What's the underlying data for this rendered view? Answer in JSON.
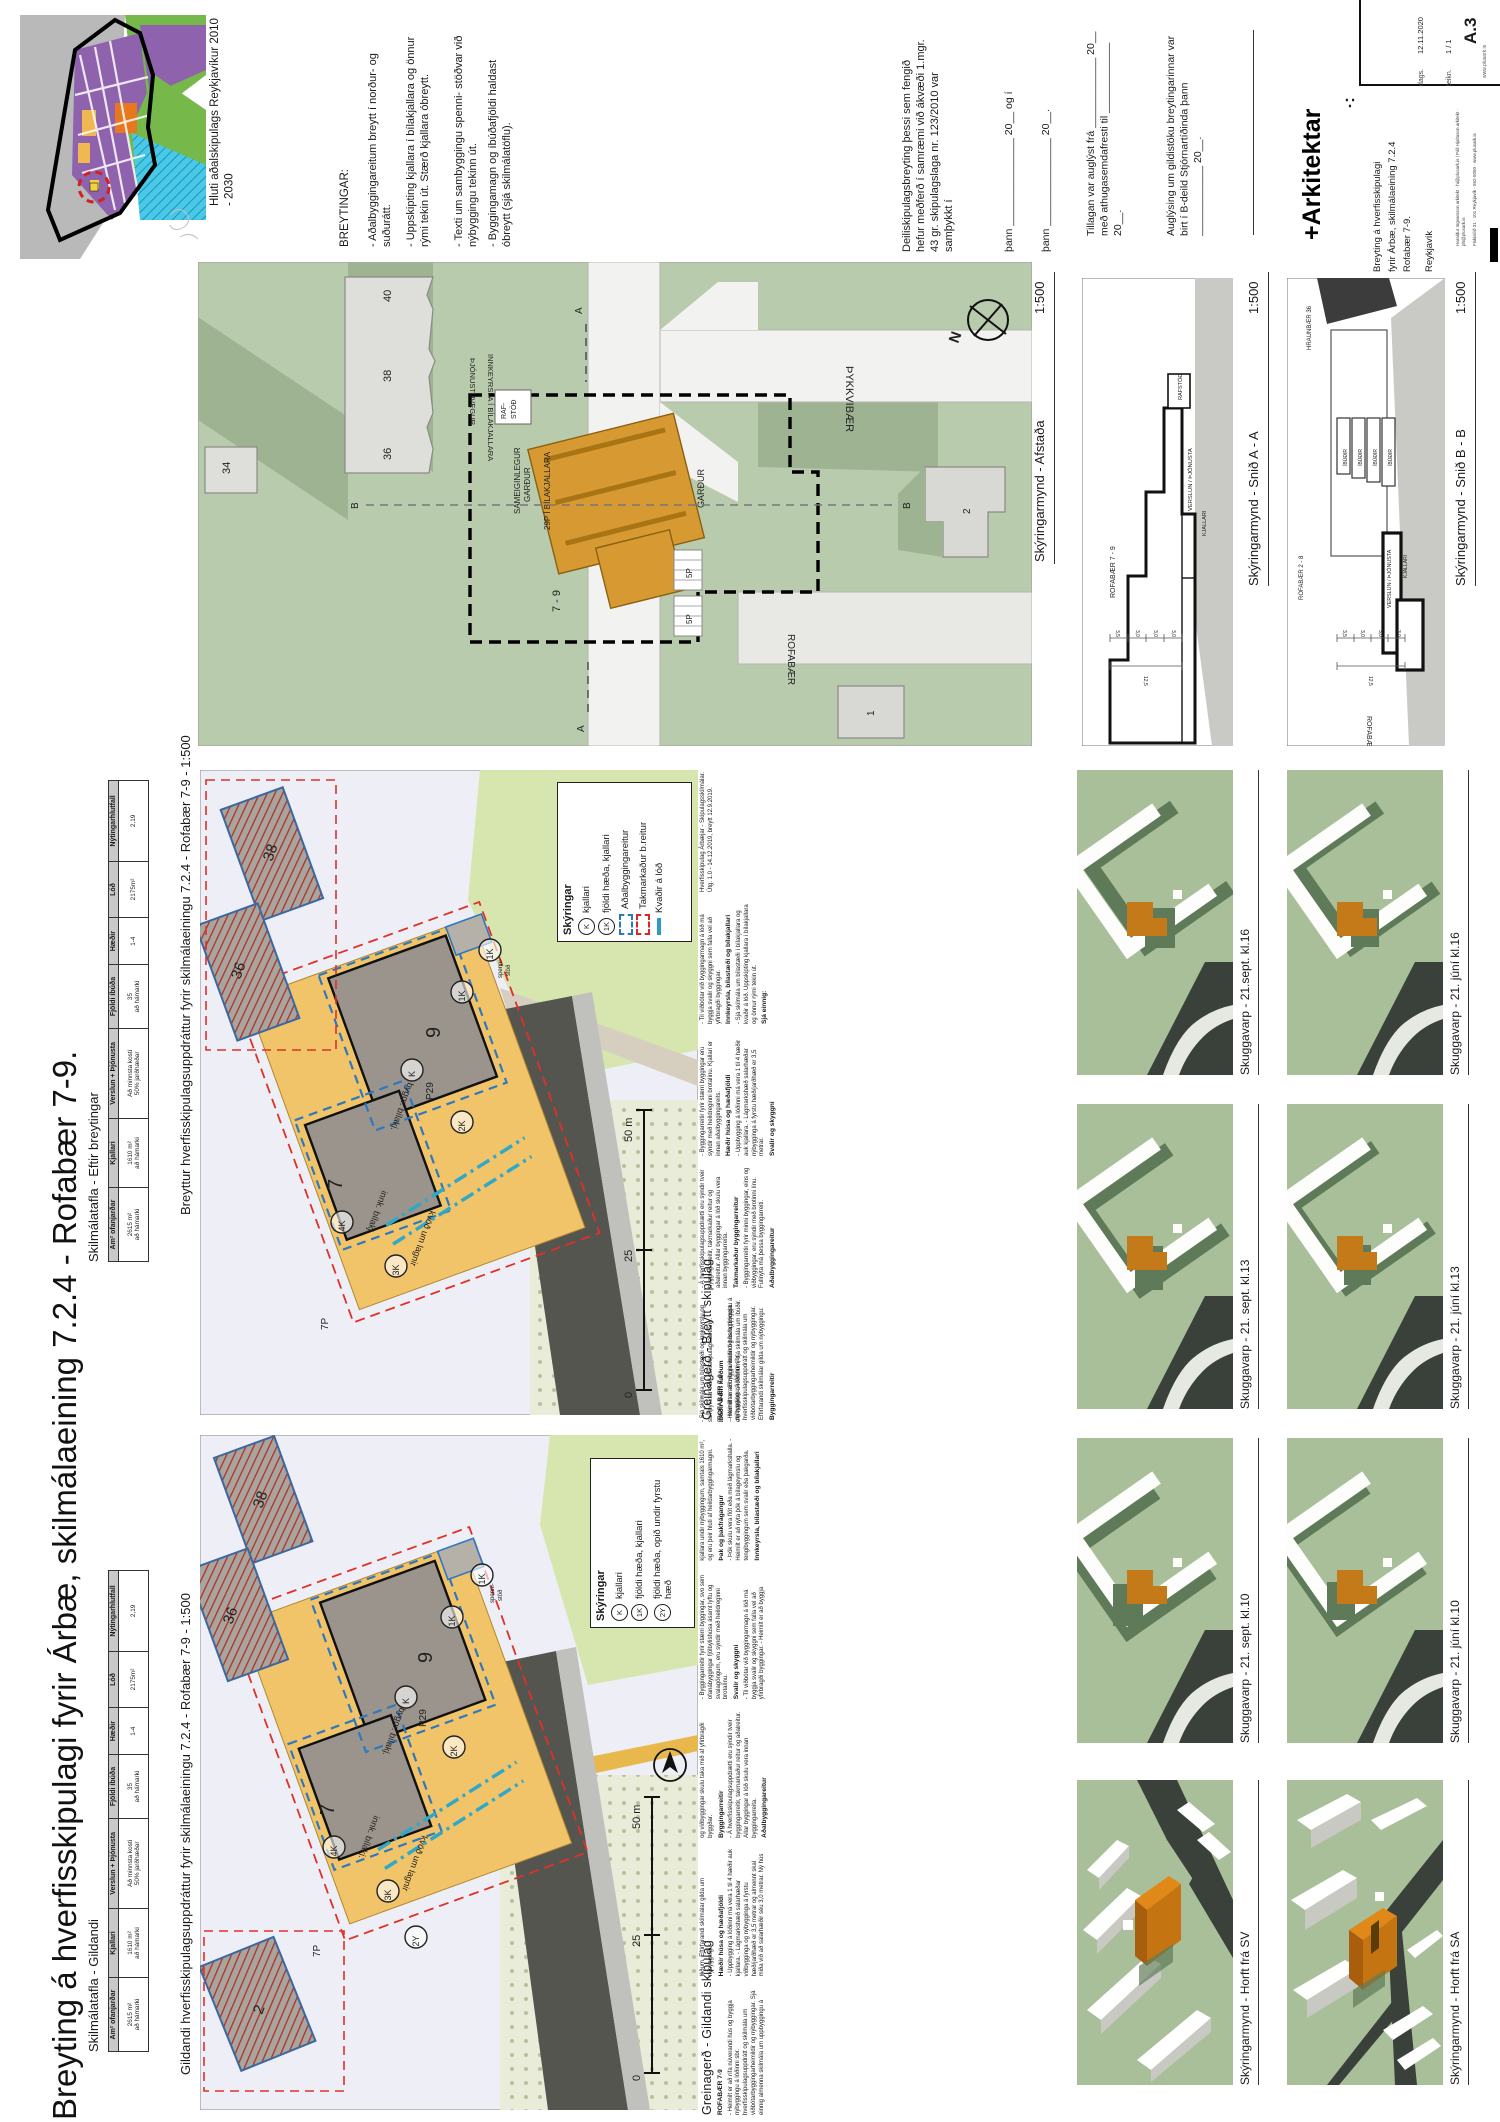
{
  "main_title": "Breyting á hverfisskipulagi fyrir Árbæ, skilmálaeining 7.2.4 - Rofabær 7-9.",
  "map": {
    "caption": "Hluti aðalskipulags Reykjavíkur 2010 - 2030"
  },
  "breytingar": {
    "heading": "BREYTINGAR:",
    "b1": "- Aðalbyggingareitum breytt í norður- og suðurátt.",
    "b2": "- Uppskipting kjallara í bílakjallara og önnur rými tekin út. Stærð kjallara óbreytt.",
    "b3": "- Texti um sambyggingu spenni- stöðvar við nýbyggingu tekinn út.",
    "b4": "- Byggingamagn og íbúðafjöldi haldast óbreytt (sjá skilmálatöflu)."
  },
  "approval": {
    "paragraph": "Deiliskipulagsbreyting þessi sem fengið hefur meðferð í samræmi við ákvæði 1.mgr. 43 gr. skipulagslaga nr. 123/2010 var samþykkt í",
    "line1": "þann _______________ 20__ og í",
    "line2": "þann _______________ 20__.",
    "advertised": "Tillagan var auglýst frá ____________ 20__ með athugasemdafresti til ____________ 20__.",
    "published": "Auglýsing um gildistöku breytingarinnar var birt í B-deild Stjórnartíðinda þann ____________ 20__."
  },
  "titleblock": {
    "logo": "+Arkitektar",
    "mark": "∴",
    "project_line1": "Breyting á hverfisskipulagi",
    "project_line2": "fyrir Árbæ, skilmálaeining 7.2.4",
    "project_line3": "Rofabær 7-9.",
    "city": "Reykjavík",
    "dags_label": "dags.",
    "dags_value": "12.11.2020",
    "teikn_label": "teikn.",
    "teikn_value": "1 / 1",
    "sheet_no": "A.3",
    "website": "www.plusark.is",
    "credits": "Haraldur Ingvarsson arkitekt · hi@plusark.is  |  Páll Hjaltason arkitekt · ph@plusark.is",
    "address": "Fiskislóð 31 · 101 Reykjavík · 562-5050 · www.plusark.is"
  },
  "afstada": {
    "caption": "Skýringarmynd - Afstaða",
    "scale": "1:500",
    "labels": {
      "n34": "34",
      "n36": "36",
      "n38": "38",
      "n40": "40",
      "n1": "1",
      "n2": "2",
      "rafstod1": "RAF-",
      "rafstod2": "STÖÐ",
      "sam1": "SAMEIGINLEGUR",
      "sam2": "GARÐUR",
      "p29": "29P Í BÍLAKJALLARA",
      "innkeyrsla": "INNKEYRSLA Í BÍLAKJALLARA",
      "tjonustuvegur": "ÞJÓNUSTUVEGUR",
      "tykkvibaer": "ÞYKKVIBÆR",
      "gardur": "GARÐUR",
      "rofabaer": "ROFABÆR",
      "b79": "7 - 9",
      "p5": "5P",
      "north": "N",
      "mA": "A",
      "mB": "B"
    }
  },
  "snida": {
    "caption": "Skýringarmynd - Snið A - A",
    "scale": "1:500",
    "labels": {
      "building": "ROFABÆR 7 - 9",
      "rafstod": "RAFSTÖÐ",
      "verslun": "VERSLUN / ÞJÓNUSTA",
      "kjallari": "KJALLARI",
      "d125": "12,5",
      "d35": "3,5",
      "d30": "3,0"
    }
  },
  "snidb": {
    "caption": "Skýringarmynd - Snið B - B",
    "scale": "1:500",
    "labels": {
      "hraunbaer": "HRAUNBÆR 36",
      "rofabaer28": "ROFABÆR 2 - 8",
      "ibudir": "ÍBÚÐIR",
      "verslun": "VERSLUN / ÞJÓNUSTA",
      "kjallari": "KJALLARI",
      "street": "ROFABÆR",
      "d125": "12,5",
      "d35": "3,5",
      "d30": "3,0"
    }
  },
  "tables": {
    "gildandi_heading": "Skilmálatafla -  Gildandi",
    "breytt_heading": "Skilmálatafla -  Eftir breytingar",
    "cols": [
      {
        "h": "Am² ofanjarðar",
        "v": "2615 m²",
        "s": "að hámarki"
      },
      {
        "h": "Kjallari",
        "v": "1610 m²",
        "s": "að hámarki"
      },
      {
        "h": "Verslun + Þjónusta",
        "v": "Að minnsta kosti",
        "s": "50% jarðhæðar"
      },
      {
        "h": "Fjöldi íbúða",
        "v": "35",
        "s": "að hámarki"
      },
      {
        "h": "Hæðir",
        "v": "1-4",
        "s": ""
      },
      {
        "h": "Lóð",
        "v": "2175m²",
        "s": ""
      },
      {
        "h": "Nýtingarhlutfall",
        "v": "2,19",
        "s": ""
      }
    ]
  },
  "plans": {
    "gildandi_caption": "Gildandi hverfisskipulagsuppdráttur fyrir skilmálaeiningu 7.2.4 - Rofabær 7-9 - 1:500",
    "breytt_caption": "Breyttur hverfisskipulagsuppdráttur fyrir skilmálaeiningu 7.2.4 - Rofabær 7-9 - 1:500",
    "legend_title": "Skýringar",
    "legend_breytt": [
      {
        "sym": "K",
        "label": "kjallari"
      },
      {
        "sym": "1K",
        "label": "fjöldi hæða, kjallari"
      },
      {
        "sym": "",
        "label": "Aðalbyggingareitur"
      },
      {
        "sym": "",
        "label": "Takmarkaður b.reitur"
      },
      {
        "sym": "",
        "label": "Kvaðir á lóð"
      }
    ],
    "legend_gildandi": [
      {
        "sym": "K",
        "label": "kjallari"
      },
      {
        "sym": "1K",
        "label": "fjöldi hæða, kjallari"
      },
      {
        "sym": "2Y",
        "label": "fjöldi hæða, opið undir fyrstu hæð"
      }
    ],
    "labels": {
      "n7": "7",
      "n9": "9",
      "p29": "P29",
      "k4": "4K",
      "k3": "3K",
      "k2": "2K",
      "k1": "1K",
      "k": "K",
      "y2": "2Y",
      "p7": "7P",
      "sp1": "spenni-",
      "sp2": "stöð",
      "byggr": "byggr. bílakj.",
      "innk": "innk. bílakj.",
      "kvod": "kvöð um lagnir",
      "n36": "36",
      "n38": "38",
      "n2": "2",
      "s0": "0",
      "s25": "25",
      "s50": "50 m"
    }
  },
  "greinagerd": {
    "gildandi_heading": "Greinagerð - Gildandi skipulag",
    "breytt_heading": "Greinagerð - Breytt skipulag",
    "gildandi_sections": [
      {
        "h": "ROFABÆR 7-9",
        "b": "- Heimilt er að rífa núverandi hús og byggja nýbyggingu á lóðinni sbr. hverfisskipulagsuppdrátt og skilmála um viðbótarbyggingarheimildir og nýbyggingar. Sjá einnig almenna skilmála um uppbyggingu á lóðum. Eftirfarandi skilmálar gilda um nýbyggingu:"
      },
      {
        "h": "Hæðir húsa og hæðafjöldi",
        "b": "- Uppbygging á lóðinni má vera 1 til 4 hæðir auk kjallara. - Lágmarkshæð salarhæðar viðbygginga og nýbygginga á fyrstu hæð/jarðhæð er 3,5 metrar og almennt skal miða við að salarhæðir séu 3,0 metrar. Ný hús og viðbyggingar skulu taka mið af yfirbragði byggðar."
      },
      {
        "h": "Byggingarreitir",
        "b": "- Á hverfisskipulagsuppdrætti eru sýndir tveir byggingarreitir, takmarkaður reitur og aðalreitur. Allar byggingar á lóð skulu vera innan byggingarreita."
      },
      {
        "h": "Aðalbyggingareitur",
        "b": "- Byggingarreitir fyrir stærri byggingar, svo sem ofanábyggingar fjölbýlishúsa ásamt lyftu og svalagöngum, eru sýndir með heildreginni brotalínu."
      },
      {
        "h": "Svalir og skyggni",
        "b": "- Til viðbótar við byggingarmagn á lóð má byggja svalir og skyggni sem falla vel að yfirbragði byggingar. - Heimilt er að byggja kjallara undir nýbyggingum, samtals 1610 m², og eru þeir hluti af heildarbyggingarmagni."
      },
      {
        "h": "Þak og þakfrágangur",
        "b": "- Þök skulu vera flöt eða með lágmarkshalla. - Heimilt er að nýta þök á bílageymslu og tengibyggingum sem svalir eða þakgarða."
      },
      {
        "h": "Innkeyrsla, bílastæði og bílakjallari",
        "b": "- Sjá skilmála um bílastæði og innkeyrslu og samþykktar eldri deiliskipulagsáætlanir."
      },
      {
        "h": "Íbúðir á efri hæðum",
        "b": "- Heimilt er að byggja íbúðir og hafa þjónustu á efri hæðum á lóðunum, sjá skilmála um íbúðir."
      }
    ],
    "breytt_sections": [
      {
        "h": "ROFABÆR 7-9",
        "b": "- Heimilt er að rífa núverandi hús og byggja nýbyggingu á lóðinni sbr. hverfisskipulagsuppdrátt og skilmála um viðbótarbyggingarheimildir og nýbyggingar. Eftirfarandi skilmálar gilda um nýbyggingu:"
      },
      {
        "h": "Byggingarreitir",
        "b": "- Á hverfisskipulagsuppdrætti eru sýndir tveir byggingarreitir, takmarkaður reitur og aðalreitur. Allar byggingar á lóð skulu vera innan byggingarreita."
      },
      {
        "h": "Takmarkaður byggingarreitur",
        "b": "- Byggingarreitir fyrir minni byggingar, eins og viðbyggingar, eru sýndir með brotinni línu. Fullnýta má þessa byggingarreiti."
      },
      {
        "h": "Aðalbyggingareitur",
        "b": "- Byggingarreitir fyrir stærri byggingar eru sýndir með heildreginni brotalínu. Kjallari er innan aðalbyggingareits."
      },
      {
        "h": "Hæðir húsa og hæðafjöldi",
        "b": "- Uppbygging á lóðinni má vera 1 til 4 hæðir auk kjallara. - Lágmarkshæð salarhæðar nýbygginga á fyrstu hæð/jarðhæð er 3,5 metrar."
      },
      {
        "h": "Svalir og skyggni",
        "b": "- Til viðbótar við byggingarmagn á lóð má byggja svalir og skyggni sem falla vel að yfirbragði byggingar."
      },
      {
        "h": "Innkeyrsla, bílastæði og bílakjallari",
        "b": "- Sjá skilmála um bílastæði í bílakjallara og kvaðir á lóð. Uppskipting kjallara í bílakjallara og önnur rými tekin út."
      },
      {
        "h": "Sjá einnig:",
        "b": "Hverfisskipulag Árbæjar - Skipulagsskilmálar. Útg. 1.0 - 14.12.2019, breytt 12.9.2019."
      }
    ]
  },
  "studies": {
    "sept16": "Skuggavarp - 21.sept. kl.16",
    "sept13": "Skuggavarp - 21. sept. kl.13",
    "sept10": "Skuggavarp - 21. sept. kl.10",
    "sv": "Skýringarmynd - Horft frá SV",
    "jun16": "Skuggavarp - 21. júní kl.16",
    "jun13": "Skuggavarp - 21. júní kl.13",
    "jun10": "Skuggavarp - 21. júní kl.10",
    "sa": "Skýringarmynd - Horft frá SA"
  }
}
